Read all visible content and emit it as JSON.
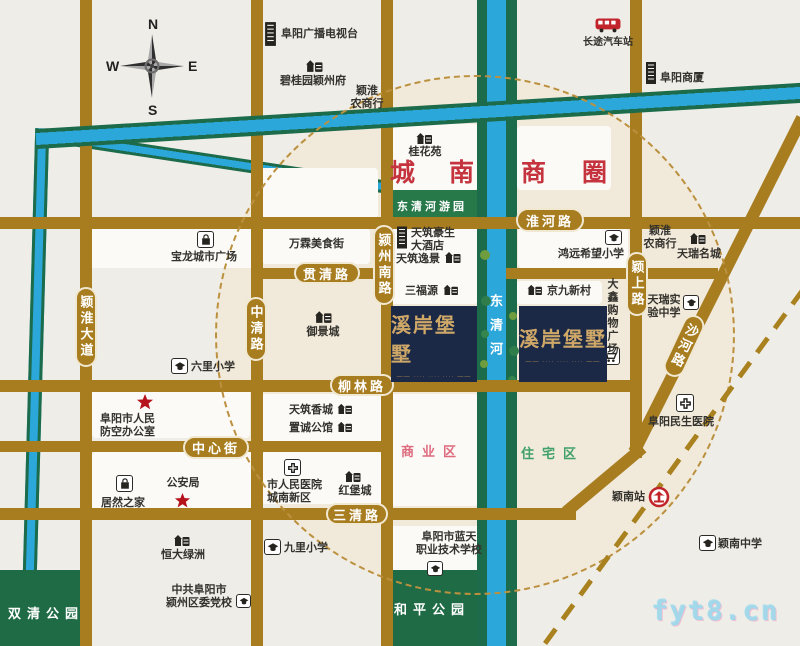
{
  "compass": {
    "n": "N",
    "s": "S",
    "w": "W",
    "e": "E"
  },
  "watermark": "fyt8.cn",
  "wanda": {
    "title": "万达广场",
    "subtitle": "WANDA PLAZA"
  },
  "project": {
    "title": "溪岸堡墅",
    "tagline": "···· ···· ····"
  },
  "palette": {
    "road": "#a87d20",
    "river": "#2ba7da",
    "river_bank": "#1c6b4b",
    "park": "#1e6b45",
    "badge_navy": "#1b2947",
    "badge_gold": "#cfa868",
    "brand_red": "#c5232d",
    "zone_red": "#c5333e",
    "zone_pink": "#de6a7e",
    "zone_green": "#3fa06a"
  },
  "map": {
    "circle": {
      "x": 215,
      "y": 75,
      "d": 520
    },
    "railway": {
      "x": 545,
      "y": 641,
      "w": 441,
      "h": 5,
      "rot": -53.9
    },
    "areas": [
      {
        "id": "block-guihuayuan",
        "cls": "blk",
        "x": 386,
        "y": 124,
        "w": 92,
        "h": 66
      },
      {
        "id": "block-shangquan",
        "cls": "blk",
        "x": 517,
        "y": 126,
        "w": 94,
        "h": 64
      },
      {
        "id": "block-wanda",
        "cls": "blk",
        "x": 253,
        "y": 168,
        "w": 125,
        "h": 50
      },
      {
        "id": "block-wanlin",
        "cls": "blk",
        "x": 262,
        "y": 228,
        "w": 108,
        "h": 36
      },
      {
        "id": "block-baolong",
        "cls": "blk",
        "x": 90,
        "y": 224,
        "w": 166,
        "h": 44
      },
      {
        "id": "block-tianzhu",
        "cls": "blk",
        "x": 386,
        "y": 222,
        "w": 92,
        "h": 82
      },
      {
        "id": "block-hongyuan",
        "cls": "blk",
        "x": 518,
        "y": 228,
        "w": 110,
        "h": 40
      },
      {
        "id": "block-jingjiu",
        "cls": "blk",
        "x": 516,
        "y": 281,
        "w": 86,
        "h": 23
      },
      {
        "id": "block-shangyequ",
        "cls": "blk",
        "x": 386,
        "y": 394,
        "w": 92,
        "h": 112
      },
      {
        "id": "block-south",
        "cls": "blk",
        "x": 386,
        "y": 526,
        "w": 94,
        "h": 46
      },
      {
        "id": "block-xiangcheng",
        "cls": "blk",
        "x": 262,
        "y": 394,
        "w": 156,
        "h": 48
      },
      {
        "id": "block-hospital",
        "cls": "blk",
        "x": 262,
        "y": 452,
        "w": 120,
        "h": 52
      },
      {
        "id": "block-gonganju",
        "cls": "blk",
        "x": 92,
        "y": 452,
        "w": 162,
        "h": 64
      },
      {
        "id": "block-fangkong",
        "cls": "blk",
        "x": 92,
        "y": 390,
        "w": 158,
        "h": 48
      },
      {
        "id": "shuangqing-park",
        "cls": "park",
        "x": 0,
        "y": 570,
        "w": 86,
        "h": 76
      },
      {
        "id": "heping-park",
        "cls": "park",
        "x": 386,
        "y": 570,
        "w": 94,
        "h": 76
      },
      {
        "id": "dongqinghe-riverside-park",
        "cls": "greenbar",
        "x": 386,
        "y": 190,
        "w": 92,
        "h": 32
      }
    ],
    "rivers": [
      {
        "id": "west-river",
        "cls": "riv-v",
        "x": 28,
        "y": 128,
        "w": 14,
        "h": 520,
        "rot": 1.6
      },
      {
        "id": "river-branch",
        "cls": "riv-h2",
        "x": 52,
        "y": 130,
        "w": 338,
        "h": 13,
        "rot": 8.6
      },
      {
        "id": "dongqinghe-west-bank",
        "cls": "riv-bank",
        "x": 477,
        "y": 0,
        "w": 10,
        "h": 646
      },
      {
        "id": "dongqinghe-river",
        "cls": "riv-blue",
        "x": 487,
        "y": 0,
        "w": 19,
        "h": 646
      },
      {
        "id": "dongqinghe-east-bank",
        "cls": "riv-bank",
        "x": 506,
        "y": 0,
        "w": 11,
        "h": 646
      }
    ],
    "top_river": {
      "id": "north-river",
      "cls": "riv-h",
      "x": 36,
      "y": 129,
      "w": 772,
      "h": 20,
      "rot": -3.45
    },
    "roads": [
      {
        "id": "yinghuai-avenue",
        "x": 80,
        "y": 0,
        "w": 12,
        "h": 646
      },
      {
        "id": "zhongqing-road",
        "x": 251,
        "y": 0,
        "w": 12,
        "h": 646
      },
      {
        "id": "yingzhou-south-road",
        "x": 381,
        "y": 0,
        "w": 12,
        "h": 646
      },
      {
        "id": "yingshang-road",
        "x": 630,
        "y": 0,
        "w": 12,
        "h": 458
      },
      {
        "id": "huaihe-road",
        "x": 0,
        "y": 217,
        "w": 800,
        "h": 12
      },
      {
        "id": "guanqing-road-west",
        "x": 251,
        "y": 268,
        "w": 142,
        "h": 11
      },
      {
        "id": "guanqing-road-east",
        "x": 506,
        "y": 268,
        "w": 212,
        "h": 11
      },
      {
        "id": "liulin-road",
        "x": 0,
        "y": 380,
        "w": 640,
        "h": 12
      },
      {
        "id": "zhongxin-street",
        "x": 0,
        "y": 441,
        "w": 392,
        "h": 11
      },
      {
        "id": "sanqing-road",
        "x": 0,
        "y": 508,
        "w": 576,
        "h": 12
      },
      {
        "id": "sanqing-curve",
        "x": 566,
        "y": 506,
        "w": 100,
        "h": 12,
        "rot": -40
      },
      {
        "id": "shahe-road",
        "x": 634,
        "y": 446,
        "w": 374,
        "h": 12,
        "rot": -63.3
      }
    ],
    "pills": [
      {
        "id": "huaihe-road-label",
        "text": "淮河路",
        "x": 516,
        "y": 208,
        "w": 68,
        "h": 24
      },
      {
        "id": "guanqing-road-label",
        "text": "贯清路",
        "x": 294,
        "y": 262,
        "w": 66,
        "h": 22
      },
      {
        "id": "liulin-road-label",
        "text": "柳林路",
        "x": 330,
        "y": 374,
        "w": 64,
        "h": 22
      },
      {
        "id": "zhongxin-street-label",
        "text": "中心街",
        "x": 183,
        "y": 436,
        "w": 66,
        "h": 23
      },
      {
        "id": "sanqing-road-label",
        "text": "三清路",
        "x": 326,
        "y": 503,
        "w": 62,
        "h": 22
      },
      {
        "id": "yinghuai-avenue-label",
        "text": "颖淮大道",
        "x": 75,
        "y": 287,
        "w": 22,
        "h": 80,
        "vert": true
      },
      {
        "id": "zhongqing-road-label",
        "text": "中清路",
        "x": 245,
        "y": 297,
        "w": 22,
        "h": 64,
        "vert": true
      },
      {
        "id": "yingzhou-south-road-label",
        "text": "颍州南路",
        "x": 373,
        "y": 225,
        "w": 22,
        "h": 80,
        "vert": true
      },
      {
        "id": "yingshang-road-label",
        "text": "颖上路",
        "x": 626,
        "y": 252,
        "w": 22,
        "h": 64,
        "vert": true
      },
      {
        "id": "shahe-road-label",
        "text": "沙河路",
        "x": 673,
        "y": 313,
        "w": 22,
        "h": 66,
        "vert": true,
        "rot": 25
      }
    ],
    "zones": [
      {
        "id": "chengnan-label",
        "cls": "zone big-red",
        "text": "城南",
        "x": 390,
        "y": 153,
        "w": 84
      },
      {
        "id": "shangquan-label",
        "cls": "zone big-red",
        "text": "商圈",
        "x": 521,
        "y": 153,
        "w": 86
      },
      {
        "id": "dongqinghe-park-label",
        "cls": "zone parkbar-label",
        "text": "东清河游园",
        "x": 391,
        "y": 198,
        "w": 82
      },
      {
        "id": "shangyequ-label",
        "cls": "zone pink",
        "text": "商业区",
        "x": 401,
        "y": 441,
        "w": 80
      },
      {
        "id": "zhuzhaiqu-label",
        "cls": "zone greent",
        "text": "住宅区",
        "x": 521,
        "y": 443,
        "w": 76
      },
      {
        "id": "heping-park-label",
        "cls": "zone parklabel",
        "text": "和平公园",
        "x": 394,
        "y": 599,
        "w": 84
      },
      {
        "id": "shuangqing-park-label",
        "cls": "zone parklabel",
        "text": "双清公园",
        "x": 8,
        "y": 603,
        "w": 82
      },
      {
        "id": "dongqinghe-river-label",
        "cls": "zone river-label",
        "text": "东清河",
        "x": 489,
        "y": 294,
        "w": 16
      }
    ],
    "trees": [
      {
        "x": 480,
        "y": 250,
        "r": 5,
        "c": "#6f9c3f"
      },
      {
        "x": 508,
        "y": 268,
        "r": 4,
        "c": "#2f7d4a"
      },
      {
        "x": 481,
        "y": 296,
        "r": 5,
        "c": "#2f7d4a"
      },
      {
        "x": 509,
        "y": 312,
        "r": 4,
        "c": "#6f9c3f"
      },
      {
        "x": 481,
        "y": 330,
        "r": 4,
        "c": "#35854f"
      },
      {
        "x": 509,
        "y": 346,
        "r": 5,
        "c": "#2f7d4a"
      },
      {
        "x": 480,
        "y": 360,
        "r": 4,
        "c": "#6f9c3f"
      },
      {
        "x": 508,
        "y": 376,
        "r": 4,
        "c": "#35854f"
      }
    ],
    "pois": [
      {
        "name": "fuyang-tv-station",
        "icon": "tower",
        "ix": 264,
        "iy": 22,
        "iw": 13,
        "ih": 24,
        "lines": [
          "阜阳广播电视台"
        ],
        "tx": 281,
        "ty": 28,
        "tw": 92,
        "ta": "left"
      },
      {
        "name": "biguiyuan-yingzhoufu",
        "icon": "build",
        "ix": 305,
        "iy": 58,
        "iw": 18,
        "ih": 14,
        "lines": [
          "碧桂园颖州府"
        ],
        "tx": 280,
        "ty": 75,
        "tw": 72,
        "ta": "left"
      },
      {
        "name": "yinghuai-rural-bank-north",
        "lines": [
          "颖淮",
          "农商行"
        ],
        "tx": 346,
        "ty": 85,
        "tw": 42,
        "ta": "center"
      },
      {
        "name": "long-distance-bus-station",
        "icon": "bus",
        "ix": 595,
        "iy": 17,
        "iw": 26,
        "ih": 16,
        "lines": [
          "长途汽车站"
        ],
        "tx": 578,
        "ty": 37,
        "tw": 60,
        "ta": "center",
        "fs": 10
      },
      {
        "name": "fuyang-building",
        "icon": "tower",
        "ix": 645,
        "iy": 60,
        "iw": 12,
        "ih": 26,
        "lines": [
          "阜阳商厦"
        ],
        "tx": 660,
        "ty": 72,
        "tw": 50,
        "ta": "left"
      },
      {
        "name": "guihuayuan",
        "icon": "build",
        "ix": 415,
        "iy": 131,
        "iw": 18,
        "ih": 13,
        "lines": [
          "桂花苑"
        ],
        "tx": 407,
        "ty": 146,
        "tw": 36,
        "ta": "center"
      },
      {
        "name": "baolong-city-plaza",
        "icon": "bag",
        "boxed": true,
        "ix": 197,
        "iy": 231,
        "iw": 17,
        "ih": 17,
        "lines": [
          "宝龙城市广场"
        ],
        "tx": 171,
        "ty": 251,
        "tw": 70,
        "ta": "left"
      },
      {
        "name": "wanlin-food-street",
        "lines": [
          "万霖美食街"
        ],
        "tx": 289,
        "ty": 238,
        "tw": 60,
        "ta": "left"
      },
      {
        "name": "tianzhu-haosheng-hotel",
        "icon": "tower",
        "ix": 396,
        "iy": 225,
        "iw": 12,
        "ih": 25,
        "lines": [
          "天筑豪生",
          "大酒店"
        ],
        "tx": 411,
        "ty": 227,
        "tw": 48,
        "ta": "left"
      },
      {
        "name": "tianzhu-yijing",
        "icon": "build",
        "ix": 444,
        "iy": 250,
        "iw": 17,
        "ih": 13,
        "lines": [
          "天筑逸景"
        ],
        "tx": 396,
        "ty": 253,
        "tw": 46,
        "ta": "left"
      },
      {
        "name": "sanfuyuan",
        "icon": "build",
        "ix": 442,
        "iy": 283,
        "iw": 17,
        "ih": 12,
        "lines": [
          "三福源"
        ],
        "tx": 405,
        "ty": 285,
        "tw": 36,
        "ta": "left"
      },
      {
        "name": "jingjiu-xincun",
        "icon": "build",
        "ix": 526,
        "iy": 283,
        "iw": 17,
        "ih": 12,
        "lines": [
          "京九新村"
        ],
        "tx": 547,
        "ty": 285,
        "tw": 46,
        "ta": "left"
      },
      {
        "name": "hongyuan-hope-primary-school",
        "icon": "school",
        "boxed": true,
        "ix": 605,
        "iy": 230,
        "iw": 17,
        "ih": 15,
        "lines": [
          "鸿远希望小学"
        ],
        "tx": 558,
        "ty": 248,
        "tw": 66,
        "ta": "left"
      },
      {
        "name": "yinghuai-rural-bank-east",
        "lines": [
          "颖淮",
          "农商行"
        ],
        "tx": 640,
        "ty": 225,
        "tw": 40,
        "ta": "center"
      },
      {
        "name": "tianrui-mingcheng",
        "icon": "build",
        "ix": 689,
        "iy": 231,
        "iw": 17,
        "ih": 13,
        "lines": [
          "天瑞名城"
        ],
        "tx": 677,
        "ty": 248,
        "tw": 46,
        "ta": "left"
      },
      {
        "name": "daxin-shopping-plaza",
        "icon": "cart",
        "boxed": true,
        "ix": 600,
        "iy": 347,
        "iw": 20,
        "ih": 18,
        "lines": [
          "大鑫购物广场"
        ],
        "tx": 602,
        "ty": 278,
        "tw": 16,
        "ta": "center",
        "vert": true
      },
      {
        "name": "tianrui-experimental-school",
        "icon": "school",
        "boxed": true,
        "ix": 683,
        "iy": 295,
        "iw": 16,
        "ih": 15,
        "lines": [
          "天瑞实",
          "验中学"
        ],
        "tx": 645,
        "ty": 294,
        "tw": 38,
        "ta": "center"
      },
      {
        "name": "yujingcheng",
        "icon": "build",
        "ix": 314,
        "iy": 309,
        "iw": 18,
        "ih": 14,
        "lines": [
          "御景城"
        ],
        "tx": 303,
        "ty": 326,
        "tw": 40,
        "ta": "center"
      },
      {
        "name": "liuli-primary-school",
        "icon": "school",
        "boxed": true,
        "ix": 171,
        "iy": 358,
        "iw": 17,
        "ih": 16,
        "lines": [
          "六里小学"
        ],
        "tx": 191,
        "ty": 361,
        "tw": 46,
        "ta": "left"
      },
      {
        "name": "civil-air-defense-office",
        "icon": "star",
        "ix": 136,
        "iy": 393,
        "iw": 18,
        "ih": 18,
        "lines": [
          "阜阳市人民",
          "防空办公室"
        ],
        "tx": 100,
        "ty": 413,
        "tw": 62,
        "ta": "left"
      },
      {
        "name": "public-security-bureau",
        "icon": "star",
        "ix": 174,
        "iy": 492,
        "iw": 17,
        "ih": 17,
        "lines": [
          "公安局"
        ],
        "tx": 162,
        "ty": 477,
        "tw": 42,
        "ta": "center"
      },
      {
        "name": "juran-zhijia",
        "icon": "bag",
        "boxed": true,
        "ix": 116,
        "iy": 475,
        "iw": 17,
        "ih": 17,
        "lines": [
          "居然之家"
        ],
        "tx": 101,
        "ty": 497,
        "tw": 48,
        "ta": "left"
      },
      {
        "name": "hengda-lvzhou",
        "icon": "build",
        "ix": 173,
        "iy": 533,
        "iw": 17,
        "ih": 13,
        "lines": [
          "恒大绿洲"
        ],
        "tx": 161,
        "ty": 549,
        "tw": 48,
        "ta": "left"
      },
      {
        "name": "yingzhou-party-school",
        "icon": "school",
        "boxed": true,
        "ix": 236,
        "iy": 594,
        "iw": 15,
        "ih": 14,
        "lines": [
          "中共阜阳市",
          "颍州区委党校"
        ],
        "tx": 163,
        "ty": 584,
        "tw": 72,
        "ta": "center"
      },
      {
        "name": "tianzhu-xiangcheng",
        "icon": "build",
        "ix": 336,
        "iy": 402,
        "iw": 17,
        "ih": 12,
        "lines": [
          "天筑香城"
        ],
        "tx": 289,
        "ty": 404,
        "tw": 46,
        "ta": "left"
      },
      {
        "name": "zhicheng-gongguan",
        "icon": "build",
        "ix": 336,
        "iy": 420,
        "iw": 17,
        "ih": 12,
        "lines": [
          "置诚公馆"
        ],
        "tx": 289,
        "ty": 422,
        "tw": 46,
        "ta": "left"
      },
      {
        "name": "city-peoples-hospital-south",
        "icon": "hospital",
        "boxed": true,
        "ix": 284,
        "iy": 459,
        "iw": 17,
        "ih": 17,
        "lines": [
          "市人民医院",
          "城南新区"
        ],
        "tx": 267,
        "ty": 479,
        "tw": 58,
        "ta": "left"
      },
      {
        "name": "hongbaocheng",
        "icon": "build",
        "ix": 344,
        "iy": 469,
        "iw": 17,
        "ih": 13,
        "lines": [
          "红堡城"
        ],
        "tx": 337,
        "ty": 485,
        "tw": 36,
        "ta": "center"
      },
      {
        "name": "jiuli-primary-school",
        "icon": "school",
        "boxed": true,
        "ix": 264,
        "iy": 539,
        "iw": 17,
        "ih": 16,
        "lines": [
          "九里小学"
        ],
        "tx": 284,
        "ty": 542,
        "tw": 46,
        "ta": "left"
      },
      {
        "name": "lantian-vocational-school",
        "icon": "school",
        "boxed": true,
        "ix": 427,
        "iy": 561,
        "iw": 16,
        "ih": 15,
        "lines": [
          "阜阳市蓝天",
          "职业技术学校"
        ],
        "tx": 413,
        "ty": 531,
        "tw": 72,
        "ta": "center"
      },
      {
        "name": "minsheng-hospital",
        "icon": "hospital",
        "boxed": true,
        "ix": 676,
        "iy": 394,
        "iw": 18,
        "ih": 18,
        "lines": [
          "阜阳民生医院"
        ],
        "tx": 648,
        "ty": 416,
        "tw": 74,
        "ta": "left"
      },
      {
        "name": "yingnan-station",
        "icon": "rail",
        "ix": 648,
        "iy": 486,
        "iw": 22,
        "ih": 22,
        "lines": [
          "颖南站"
        ],
        "tx": 612,
        "ty": 491,
        "tw": 36,
        "ta": "left"
      },
      {
        "name": "yingnan-middle-school",
        "icon": "school",
        "boxed": true,
        "ix": 699,
        "iy": 535,
        "iw": 17,
        "ih": 16,
        "lines": [
          "颖南中学"
        ],
        "tx": 718,
        "ty": 538,
        "tw": 48,
        "ta": "left"
      }
    ],
    "badges": [
      {
        "id": "project-badge-west",
        "x": 391,
        "y": 306,
        "w": 86,
        "h": 76
      },
      {
        "id": "project-badge-east",
        "x": 519,
        "y": 306,
        "w": 88,
        "h": 76
      }
    ]
  }
}
